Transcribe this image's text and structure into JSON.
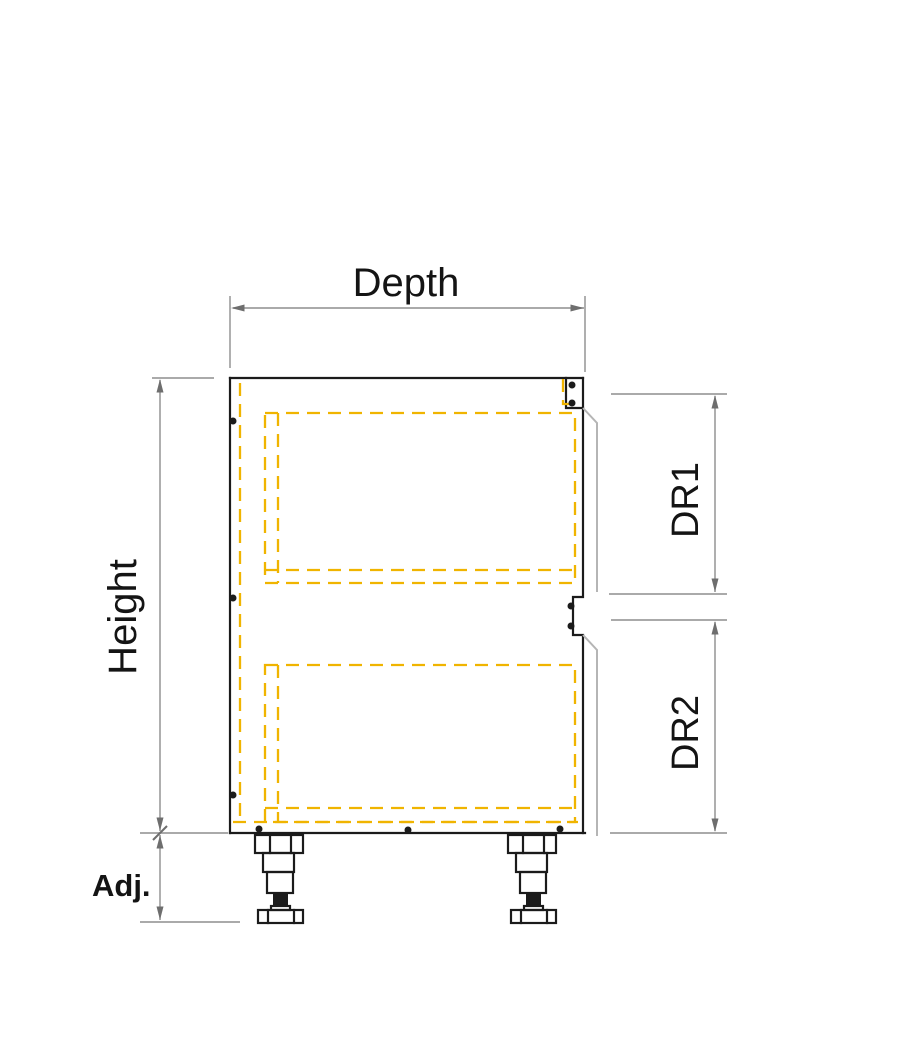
{
  "diagram": {
    "labels": {
      "depth": "Depth",
      "height": "Height",
      "drawer1": "DR1",
      "drawer2": "DR2",
      "adjustable": "Adj."
    },
    "colors": {
      "outline": "#1b1b1b",
      "dimension": "#8d8d8d",
      "arrow": "#6e6e6e",
      "hidden_line": "#f0b400",
      "edge": "#b5b5b5",
      "background": "#ffffff"
    }
  }
}
